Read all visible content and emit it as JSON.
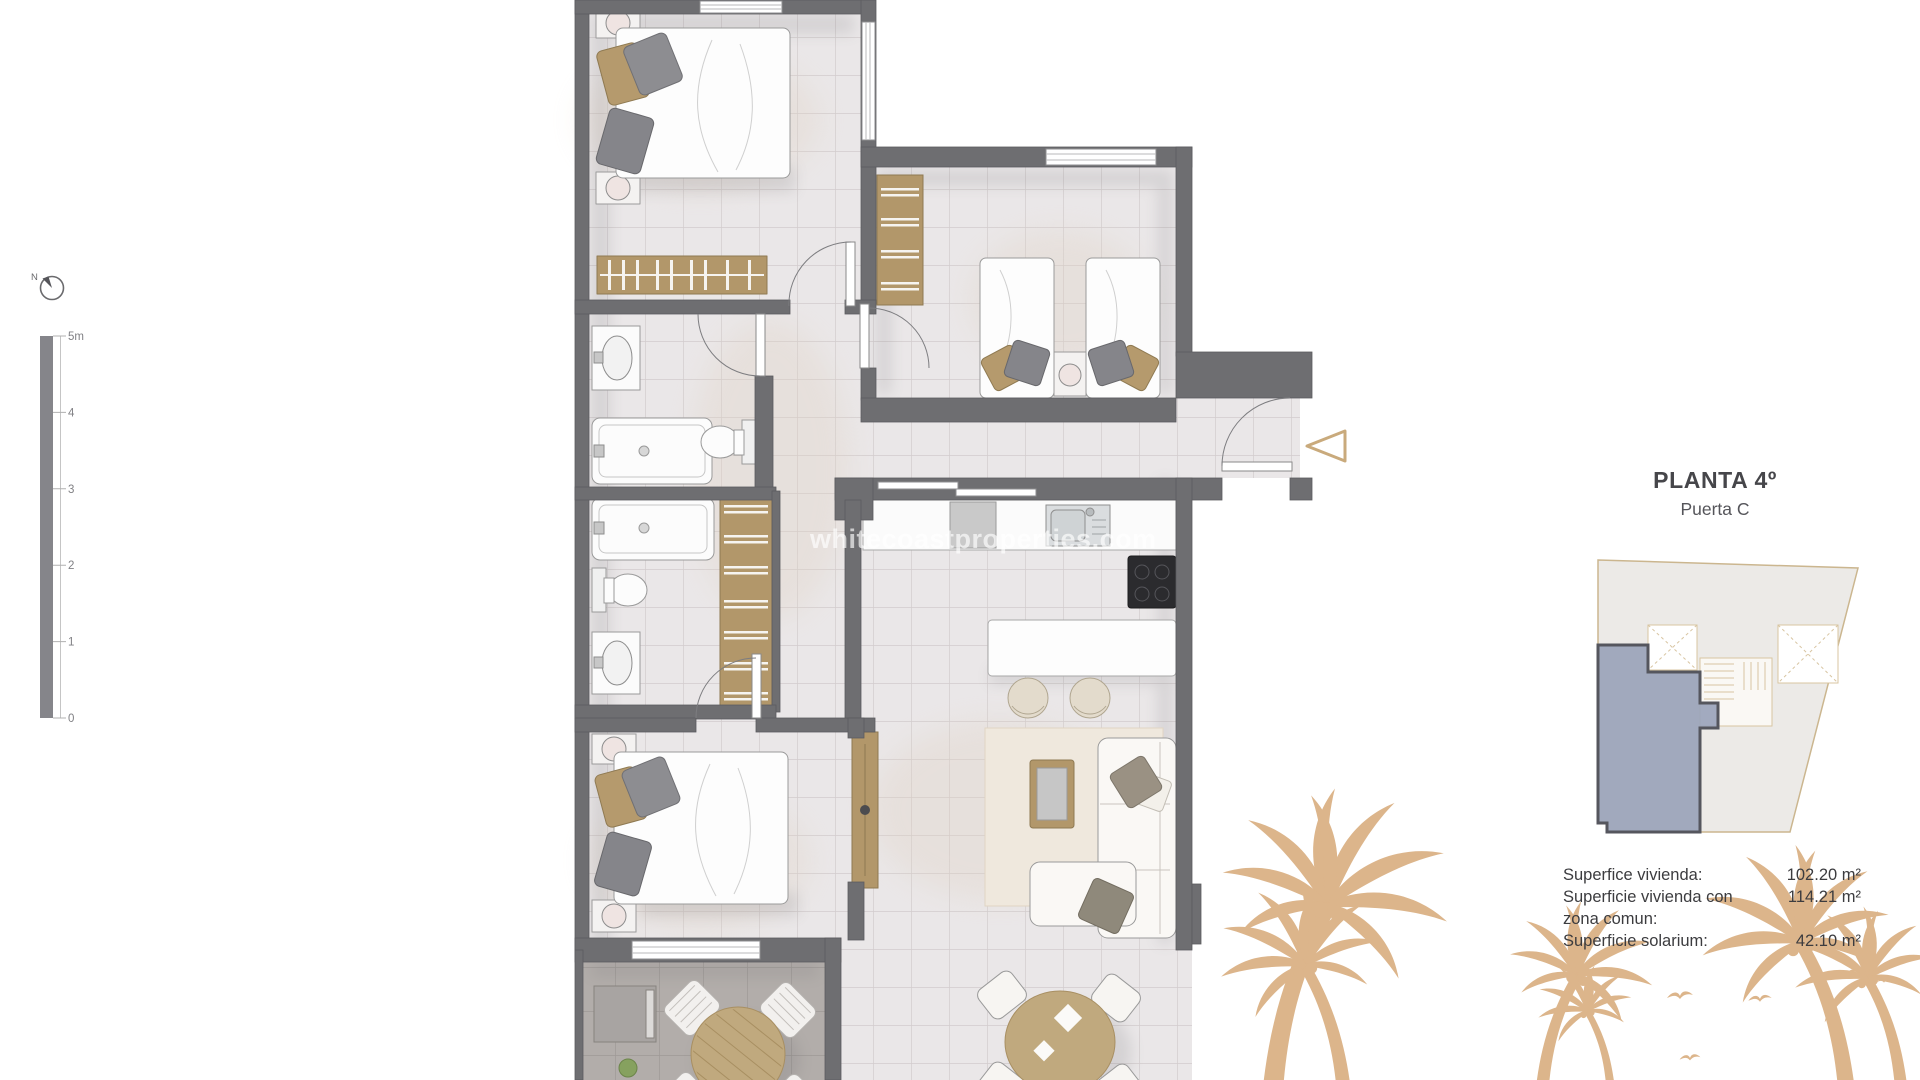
{
  "header": {
    "title": "PLANTA 4º",
    "subtitle": "Puerta C"
  },
  "areas": {
    "rows": [
      {
        "label": "Superfice vivienda:",
        "value": "102.20 m²"
      },
      {
        "label": "Superficie vivienda con",
        "value": "114.21 m²"
      },
      {
        "label": "zona comun:",
        "value": ""
      },
      {
        "label": "Superficie solarium:",
        "value": "42.10 m²"
      }
    ]
  },
  "watermark": {
    "text": "whitecoastproperties.com"
  },
  "compass": {
    "label": "N"
  },
  "scale_bar": {
    "labels": [
      "5m",
      "4",
      "3",
      "2",
      "1",
      "0"
    ]
  },
  "colors": {
    "wall": "#6e6e71",
    "floor": "#eae7e8",
    "terrace_floor": "#b2adaa",
    "wood": "#b2976a",
    "accent_tan": "#c9aa7c",
    "palm": "#dcb58b",
    "unit_highlight": "#9aa3ba"
  }
}
